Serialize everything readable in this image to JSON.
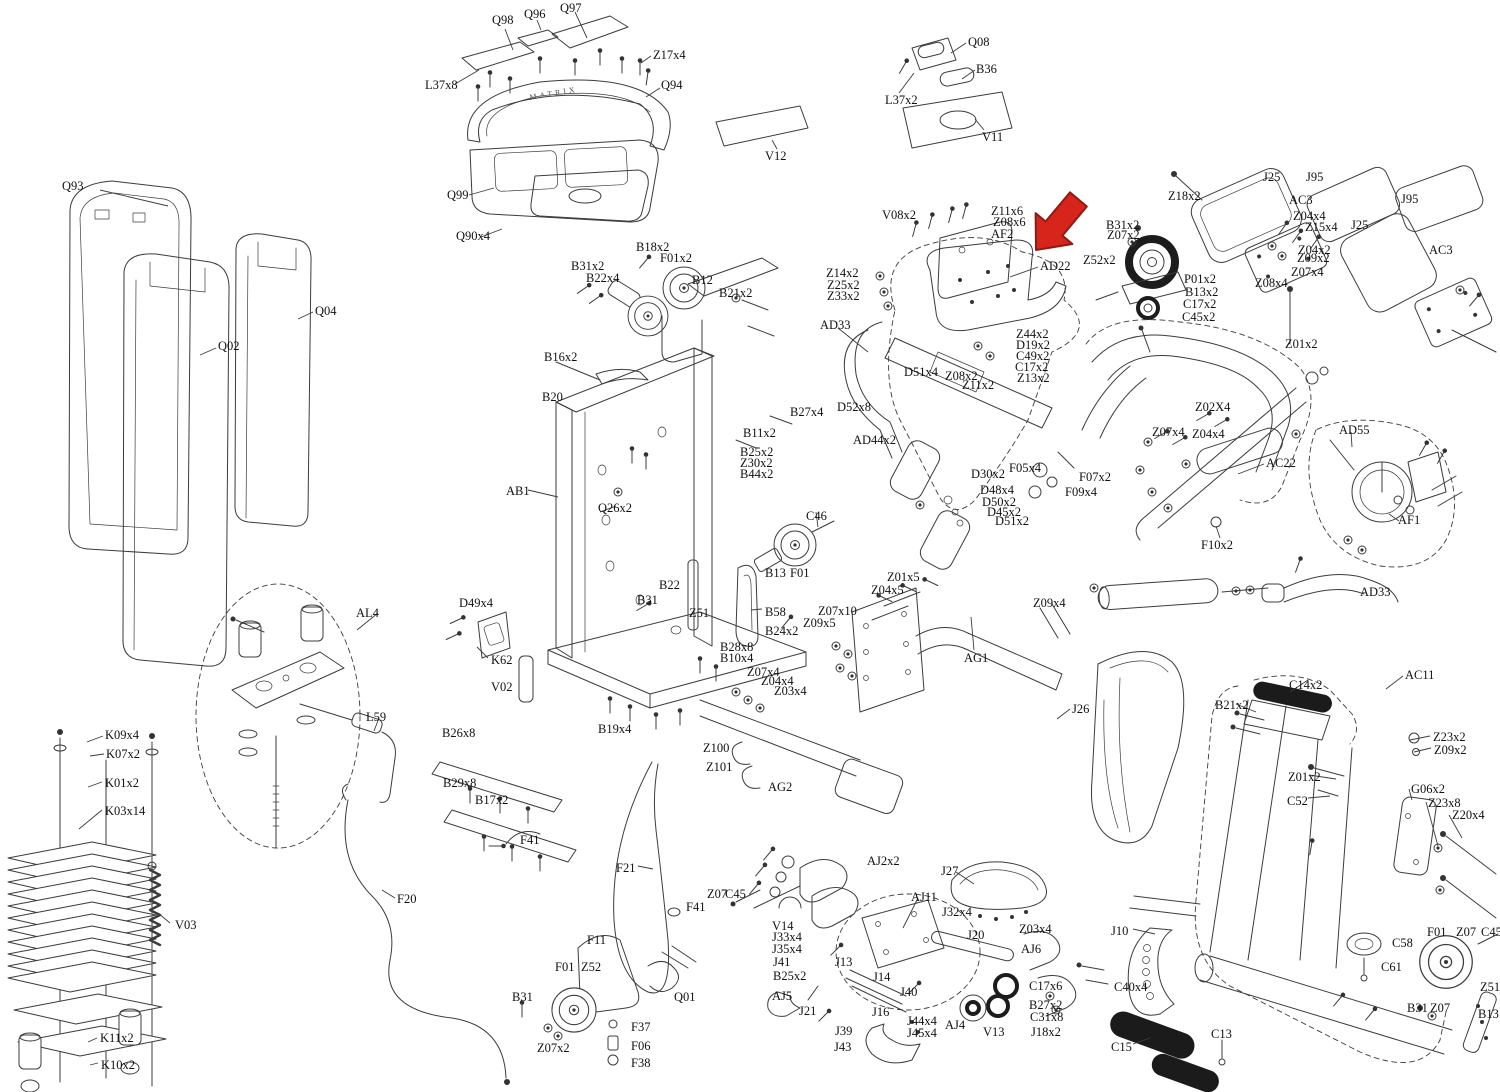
{
  "diagram": {
    "type": "exploded-parts-diagram",
    "brand_text": "MATRIX",
    "highlight": {
      "arrow_target": "AD22",
      "color": "#d8251c"
    },
    "labels": [
      {
        "t": "Q97",
        "x": 560,
        "y": 2
      },
      {
        "t": "Q98",
        "x": 492,
        "y": 14
      },
      {
        "t": "Q96",
        "x": 524,
        "y": 8
      },
      {
        "t": "Z17x4",
        "x": 653,
        "y": 49
      },
      {
        "t": "L37x8",
        "x": 425,
        "y": 79
      },
      {
        "t": "Q94",
        "x": 661,
        "y": 79
      },
      {
        "t": "Q99",
        "x": 447,
        "y": 189
      },
      {
        "t": "Q90x4",
        "x": 456,
        "y": 230
      },
      {
        "t": "Q08",
        "x": 968,
        "y": 36
      },
      {
        "t": "B36",
        "x": 976,
        "y": 63
      },
      {
        "t": "L37x2",
        "x": 885,
        "y": 94
      },
      {
        "t": "V11",
        "x": 982,
        "y": 131
      },
      {
        "t": "V12",
        "x": 765,
        "y": 150
      },
      {
        "t": "Q93",
        "x": 62,
        "y": 180
      },
      {
        "t": "Q02",
        "x": 218,
        "y": 340
      },
      {
        "t": "Q04",
        "x": 315,
        "y": 305
      },
      {
        "t": "B18x2",
        "x": 636,
        "y": 241
      },
      {
        "t": "F01x2",
        "x": 660,
        "y": 252
      },
      {
        "t": "B31x2",
        "x": 571,
        "y": 260
      },
      {
        "t": "B22x4",
        "x": 586,
        "y": 272
      },
      {
        "t": "B12",
        "x": 692,
        "y": 274
      },
      {
        "t": "B21x2",
        "x": 719,
        "y": 287
      },
      {
        "t": "B16x2",
        "x": 544,
        "y": 351
      },
      {
        "t": "B20",
        "x": 542,
        "y": 391
      },
      {
        "t": "B27x4",
        "x": 790,
        "y": 406
      },
      {
        "t": "B11x2",
        "x": 743,
        "y": 427
      },
      {
        "t": "B25x2",
        "x": 740,
        "y": 446
      },
      {
        "t": "Z30x2",
        "x": 740,
        "y": 457
      },
      {
        "t": "B44x2",
        "x": 740,
        "y": 468
      },
      {
        "t": "AB1",
        "x": 506,
        "y": 485
      },
      {
        "t": "Q26x2",
        "x": 598,
        "y": 502
      },
      {
        "t": "C46",
        "x": 806,
        "y": 510
      },
      {
        "t": "B13",
        "x": 765,
        "y": 567
      },
      {
        "t": "F01",
        "x": 790,
        "y": 567
      },
      {
        "t": "B22",
        "x": 659,
        "y": 579
      },
      {
        "t": "B31",
        "x": 637,
        "y": 594
      },
      {
        "t": "Z51",
        "x": 689,
        "y": 607
      },
      {
        "t": "B58",
        "x": 765,
        "y": 606
      },
      {
        "t": "B24x2",
        "x": 765,
        "y": 625
      },
      {
        "t": "B28x8",
        "x": 720,
        "y": 641
      },
      {
        "t": "B10x4",
        "x": 720,
        "y": 652
      },
      {
        "t": "Z07x10",
        "x": 818,
        "y": 605
      },
      {
        "t": "Z09x5",
        "x": 803,
        "y": 617
      },
      {
        "t": "Z01x5",
        "x": 887,
        "y": 571
      },
      {
        "t": "Z04x5",
        "x": 871,
        "y": 584
      },
      {
        "t": "Z09x4",
        "x": 1033,
        "y": 597
      },
      {
        "t": "AG1",
        "x": 964,
        "y": 652
      },
      {
        "t": "J26",
        "x": 1072,
        "y": 703
      },
      {
        "t": "Z07x4",
        "x": 747,
        "y": 666
      },
      {
        "t": "Z04x4",
        "x": 761,
        "y": 675
      },
      {
        "t": "Z03x4",
        "x": 774,
        "y": 685
      },
      {
        "t": "Z100",
        "x": 703,
        "y": 742
      },
      {
        "t": "Z101",
        "x": 706,
        "y": 761
      },
      {
        "t": "AG2",
        "x": 768,
        "y": 781
      },
      {
        "t": "B19x4",
        "x": 598,
        "y": 723
      },
      {
        "t": "V08x2",
        "x": 882,
        "y": 209
      },
      {
        "t": "Z11x6",
        "x": 991,
        "y": 205
      },
      {
        "t": "Z08x6",
        "x": 993,
        "y": 216
      },
      {
        "t": "AF2",
        "x": 991,
        "y": 228
      },
      {
        "t": "AD22",
        "x": 1040,
        "y": 260
      },
      {
        "t": "Z14x2",
        "x": 826,
        "y": 267
      },
      {
        "t": "Z25x2",
        "x": 827,
        "y": 279
      },
      {
        "t": "Z33x2",
        "x": 827,
        "y": 290
      },
      {
        "t": "AD33",
        "x": 820,
        "y": 319
      },
      {
        "t": "Z44x2",
        "x": 1016,
        "y": 328
      },
      {
        "t": "D19x2",
        "x": 1016,
        "y": 339
      },
      {
        "t": "C49x2",
        "x": 1016,
        "y": 350
      },
      {
        "t": "C17x2",
        "x": 1015,
        "y": 361
      },
      {
        "t": "Z13x2",
        "x": 1017,
        "y": 372
      },
      {
        "t": "D51x4",
        "x": 904,
        "y": 366
      },
      {
        "t": "Z08x2",
        "x": 945,
        "y": 370
      },
      {
        "t": "Z11x2",
        "x": 962,
        "y": 379
      },
      {
        "t": "D52x8",
        "x": 837,
        "y": 401
      },
      {
        "t": "AD44x2",
        "x": 853,
        "y": 434
      },
      {
        "t": "D30x2",
        "x": 971,
        "y": 468
      },
      {
        "t": "D48x4",
        "x": 980,
        "y": 484
      },
      {
        "t": "D50x2",
        "x": 982,
        "y": 496
      },
      {
        "t": "D45x2",
        "x": 987,
        "y": 506
      },
      {
        "t": "D51x2",
        "x": 995,
        "y": 515
      },
      {
        "t": "F05x4",
        "x": 1009,
        "y": 462
      },
      {
        "t": "F07x2",
        "x": 1079,
        "y": 471
      },
      {
        "t": "F09x4",
        "x": 1065,
        "y": 486
      },
      {
        "t": "B31x2",
        "x": 1106,
        "y": 219
      },
      {
        "t": "Z07x2",
        "x": 1107,
        "y": 229
      },
      {
        "t": "Z52x2",
        "x": 1083,
        "y": 254
      },
      {
        "t": "P01x2",
        "x": 1184,
        "y": 273
      },
      {
        "t": "B13x2",
        "x": 1185,
        "y": 286
      },
      {
        "t": "C17x2",
        "x": 1183,
        "y": 298
      },
      {
        "t": "C45x2",
        "x": 1182,
        "y": 311
      },
      {
        "t": "Z18x2",
        "x": 1168,
        "y": 190
      },
      {
        "t": "J25",
        "x": 1263,
        "y": 171
      },
      {
        "t": "J95",
        "x": 1306,
        "y": 171
      },
      {
        "t": "AC3",
        "x": 1289,
        "y": 194
      },
      {
        "t": "Z04x4",
        "x": 1293,
        "y": 210
      },
      {
        "t": "Z15x4",
        "x": 1305,
        "y": 221
      },
      {
        "t": "Z04x2",
        "x": 1298,
        "y": 244
      },
      {
        "t": "Z09x2",
        "x": 1297,
        "y": 252
      },
      {
        "t": "Z07x4",
        "x": 1291,
        "y": 266
      },
      {
        "t": "Z08x4",
        "x": 1255,
        "y": 277
      },
      {
        "t": "J95",
        "x": 1401,
        "y": 193
      },
      {
        "t": "J25",
        "x": 1351,
        "y": 219
      },
      {
        "t": "AC3",
        "x": 1429,
        "y": 244
      },
      {
        "t": "Z01x2",
        "x": 1285,
        "y": 338
      },
      {
        "t": "Z02X4",
        "x": 1195,
        "y": 401
      },
      {
        "t": "Z07x4",
        "x": 1152,
        "y": 426
      },
      {
        "t": "Z04x4",
        "x": 1192,
        "y": 428
      },
      {
        "t": "AC22",
        "x": 1266,
        "y": 457
      },
      {
        "t": "AD55",
        "x": 1339,
        "y": 424
      },
      {
        "t": "F10x2",
        "x": 1201,
        "y": 539
      },
      {
        "t": "AF1",
        "x": 1398,
        "y": 514
      },
      {
        "t": "AD33",
        "x": 1360,
        "y": 586
      },
      {
        "t": "K09x4",
        "x": 105,
        "y": 729
      },
      {
        "t": "K07x2",
        "x": 106,
        "y": 748
      },
      {
        "t": "K01x2",
        "x": 105,
        "y": 777
      },
      {
        "t": "K03x14",
        "x": 105,
        "y": 805
      },
      {
        "t": "V03",
        "x": 175,
        "y": 919
      },
      {
        "t": "K11x2",
        "x": 100,
        "y": 1032
      },
      {
        "t": "K10x2",
        "x": 101,
        "y": 1059
      },
      {
        "t": "AL4",
        "x": 356,
        "y": 607
      },
      {
        "t": "L59",
        "x": 366,
        "y": 711
      },
      {
        "t": "F20",
        "x": 397,
        "y": 893
      },
      {
        "t": "D49x4",
        "x": 459,
        "y": 597
      },
      {
        "t": "K62",
        "x": 491,
        "y": 654
      },
      {
        "t": "V02",
        "x": 491,
        "y": 681
      },
      {
        "t": "B26x8",
        "x": 442,
        "y": 727
      },
      {
        "t": "B29x8",
        "x": 443,
        "y": 777
      },
      {
        "t": "B17x2",
        "x": 475,
        "y": 794
      },
      {
        "t": "F41",
        "x": 520,
        "y": 834
      },
      {
        "t": "F21",
        "x": 616,
        "y": 862
      },
      {
        "t": "Z07",
        "x": 707,
        "y": 888
      },
      {
        "t": "C45",
        "x": 725,
        "y": 888
      },
      {
        "t": "F41",
        "x": 686,
        "y": 901
      },
      {
        "t": "F11",
        "x": 587,
        "y": 934
      },
      {
        "t": "F01",
        "x": 555,
        "y": 961
      },
      {
        "t": "Z52",
        "x": 581,
        "y": 961
      },
      {
        "t": "B31",
        "x": 512,
        "y": 991
      },
      {
        "t": "Q01",
        "x": 674,
        "y": 991
      },
      {
        "t": "Z07x2",
        "x": 537,
        "y": 1042
      },
      {
        "t": "F37",
        "x": 631,
        "y": 1021
      },
      {
        "t": "F06",
        "x": 631,
        "y": 1040
      },
      {
        "t": "F38",
        "x": 631,
        "y": 1057
      },
      {
        "t": "AJ2x2",
        "x": 867,
        "y": 855
      },
      {
        "t": "J27",
        "x": 941,
        "y": 865
      },
      {
        "t": "AJ11",
        "x": 911,
        "y": 891
      },
      {
        "t": "J32x4",
        "x": 942,
        "y": 906
      },
      {
        "t": "J20",
        "x": 967,
        "y": 929
      },
      {
        "t": "Z03x4",
        "x": 1019,
        "y": 923
      },
      {
        "t": "AJ6",
        "x": 1021,
        "y": 943
      },
      {
        "t": "V14",
        "x": 772,
        "y": 920
      },
      {
        "t": "J33x4",
        "x": 772,
        "y": 931
      },
      {
        "t": "J35x4",
        "x": 772,
        "y": 943
      },
      {
        "t": "J41",
        "x": 773,
        "y": 956
      },
      {
        "t": "B25x2",
        "x": 773,
        "y": 970
      },
      {
        "t": "AJ5",
        "x": 772,
        "y": 990
      },
      {
        "t": "J21",
        "x": 799,
        "y": 1005
      },
      {
        "t": "J13",
        "x": 835,
        "y": 956
      },
      {
        "t": "J14",
        "x": 873,
        "y": 971
      },
      {
        "t": "J40",
        "x": 900,
        "y": 986
      },
      {
        "t": "J16",
        "x": 872,
        "y": 1006
      },
      {
        "t": "J39",
        "x": 835,
        "y": 1025
      },
      {
        "t": "J43",
        "x": 834,
        "y": 1041
      },
      {
        "t": "J44x4",
        "x": 907,
        "y": 1015
      },
      {
        "t": "J45x4",
        "x": 907,
        "y": 1027
      },
      {
        "t": "AJ4",
        "x": 945,
        "y": 1019
      },
      {
        "t": "V13",
        "x": 983,
        "y": 1026
      },
      {
        "t": "C17x6",
        "x": 1029,
        "y": 980
      },
      {
        "t": "B27x2",
        "x": 1029,
        "y": 999
      },
      {
        "t": "C31x8",
        "x": 1030,
        "y": 1011
      },
      {
        "t": "J18x2",
        "x": 1031,
        "y": 1026
      },
      {
        "t": "J10",
        "x": 1111,
        "y": 925
      },
      {
        "t": "C40x4",
        "x": 1114,
        "y": 981
      },
      {
        "t": "C15",
        "x": 1111,
        "y": 1041
      },
      {
        "t": "C13",
        "x": 1211,
        "y": 1028
      },
      {
        "t": "AC11",
        "x": 1405,
        "y": 669
      },
      {
        "t": "C14x2",
        "x": 1289,
        "y": 679
      },
      {
        "t": "B21x2",
        "x": 1215,
        "y": 699
      },
      {
        "t": "Z23x2",
        "x": 1433,
        "y": 731
      },
      {
        "t": "Z09x2",
        "x": 1434,
        "y": 744
      },
      {
        "t": "Z01x2",
        "x": 1288,
        "y": 771
      },
      {
        "t": "C52",
        "x": 1287,
        "y": 795
      },
      {
        "t": "G06x2",
        "x": 1411,
        "y": 783
      },
      {
        "t": "Z23x8",
        "x": 1428,
        "y": 797
      },
      {
        "t": "Z20x4",
        "x": 1452,
        "y": 809
      },
      {
        "t": "C58",
        "x": 1392,
        "y": 937
      },
      {
        "t": "C61",
        "x": 1381,
        "y": 961
      },
      {
        "t": "F01",
        "x": 1427,
        "y": 926
      },
      {
        "t": "Z07",
        "x": 1456,
        "y": 926
      },
      {
        "t": "C45",
        "x": 1481,
        "y": 926
      },
      {
        "t": "Z51",
        "x": 1480,
        "y": 981
      },
      {
        "t": "B31",
        "x": 1407,
        "y": 1002
      },
      {
        "t": "Z07",
        "x": 1430,
        "y": 1002
      },
      {
        "t": "B13",
        "x": 1478,
        "y": 1008
      }
    ],
    "leaders": [
      [
        100,
        190,
        168,
        206
      ],
      [
        216,
        348,
        200,
        355
      ],
      [
        313,
        312,
        298,
        319
      ],
      [
        505,
        29,
        513,
        50
      ],
      [
        537,
        20,
        541,
        30
      ],
      [
        575,
        12,
        587,
        38
      ],
      [
        651,
        56,
        641,
        63
      ],
      [
        455,
        84,
        479,
        70
      ],
      [
        660,
        88,
        646,
        97
      ],
      [
        469,
        195,
        494,
        188
      ],
      [
        481,
        237,
        502,
        229
      ],
      [
        966,
        43,
        951,
        53
      ],
      [
        975,
        70,
        962,
        79
      ],
      [
        899,
        93,
        914,
        73
      ],
      [
        984,
        130,
        975,
        119
      ],
      [
        777,
        149,
        772,
        140
      ],
      [
        528,
        490,
        558,
        497
      ],
      [
        1038,
        267,
        1010,
        277
      ],
      [
        838,
        328,
        868,
        352
      ],
      [
        1264,
        464,
        1238,
        474
      ],
      [
        1351,
        432,
        1352,
        447
      ],
      [
        1399,
        521,
        1389,
        514
      ],
      [
        1220,
        538,
        1216,
        526
      ],
      [
        974,
        650,
        971,
        617
      ],
      [
        1070,
        709,
        1057,
        719
      ],
      [
        1403,
        676,
        1386,
        689
      ],
      [
        1133,
        929,
        1155,
        934
      ],
      [
        1133,
        1044,
        1150,
        1038
      ],
      [
        395,
        898,
        382,
        890
      ],
      [
        638,
        866,
        653,
        869
      ],
      [
        170,
        923,
        158,
        913
      ],
      [
        378,
        613,
        357,
        630
      ],
      [
        379,
        718,
        374,
        731
      ],
      [
        488,
        658,
        477,
        647
      ],
      [
        103,
        736,
        87,
        742
      ],
      [
        104,
        754,
        90,
        756
      ],
      [
        102,
        782,
        88,
        787
      ],
      [
        102,
        810,
        79,
        829
      ],
      [
        97,
        1038,
        88,
        1042
      ],
      [
        98,
        1063,
        90,
        1065
      ],
      [
        956,
        872,
        974,
        884
      ],
      [
        918,
        898,
        903,
        928
      ],
      [
        816,
        512,
        818,
        527
      ],
      [
        762,
        609,
        751,
        610
      ],
      [
        616,
        506,
        600,
        512
      ],
      [
        1308,
        680,
        1290,
        692
      ],
      [
        1236,
        704,
        1256,
        712
      ],
      [
        1430,
        736,
        1410,
        740
      ],
      [
        1431,
        748,
        1414,
        752
      ],
      [
        1309,
        775,
        1336,
        779
      ],
      [
        1308,
        798,
        1330,
        796
      ],
      [
        1409,
        789,
        1412,
        800
      ],
      [
        1426,
        802,
        1438,
        846
      ],
      [
        1449,
        815,
        1462,
        838
      ]
    ]
  }
}
